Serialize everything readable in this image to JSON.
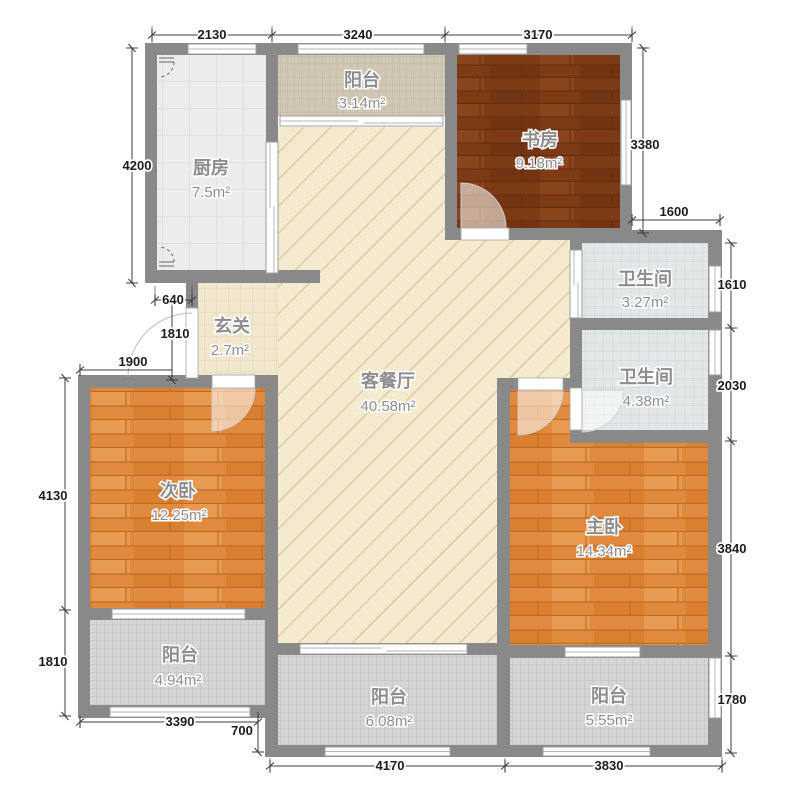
{
  "plan_title": "三室两厅户型图",
  "rooms": [
    {
      "id": "kitchen",
      "name": "厨房",
      "area": "7.5m²"
    },
    {
      "id": "balcony-top",
      "name": "阳台",
      "area": "3.14m²"
    },
    {
      "id": "study",
      "name": "书房",
      "area": "9.18m²"
    },
    {
      "id": "bathroom-1",
      "name": "卫生间",
      "area": "3.27m²"
    },
    {
      "id": "bathroom-2",
      "name": "卫生间",
      "area": "4.38m²"
    },
    {
      "id": "entrance-hall",
      "name": "玄关",
      "area": "2.7m²"
    },
    {
      "id": "living-dining",
      "name": "客餐厅",
      "area": "40.58m²"
    },
    {
      "id": "bedroom-second",
      "name": "次卧",
      "area": "12.25m²"
    },
    {
      "id": "bedroom-master",
      "name": "主卧",
      "area": "14.34m²"
    },
    {
      "id": "balcony-bl",
      "name": "阳台",
      "area": "4.94m²"
    },
    {
      "id": "balcony-bc",
      "name": "阳台",
      "area": "6.08m²"
    },
    {
      "id": "balcony-br",
      "name": "阳台",
      "area": "5.55m²"
    }
  ],
  "dimensions": {
    "top": [
      "2130",
      "3240",
      "3170"
    ],
    "left": [
      "4200",
      "640",
      "1810",
      "1900",
      "4130",
      "1810"
    ],
    "right": [
      "3380",
      "1600",
      "1610",
      "2030",
      "3840",
      "1780"
    ],
    "bottom": [
      "3390",
      "700",
      "4170",
      "3830"
    ]
  },
  "colors": {
    "wall": "#898989",
    "living_floor": "#f4ead0",
    "living_hatch": "#e0cda3",
    "wood_orange": "#e08a3d",
    "wood_dark": "#7d3b15",
    "tile_gray": "#d5d5d3",
    "tile_tan": "#d1c7b5",
    "kitchen_floor": "#ececec",
    "bath_floor": "#e1e8e7",
    "room_label": "#8d8d8d",
    "dim_label": "#1c1c1c"
  }
}
